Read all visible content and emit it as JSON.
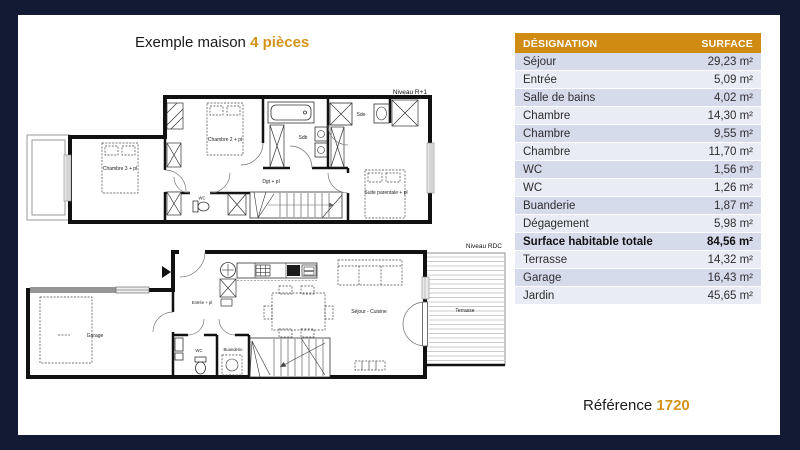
{
  "page": {
    "title_prefix": "Exemple maison",
    "title_highlight": "4 pièces",
    "reference_label": "Référence",
    "reference_value": "1720"
  },
  "table": {
    "header": {
      "designation": "DÉSIGNATION",
      "surface": "SURFACE"
    },
    "rows": [
      {
        "label": "Séjour",
        "value": "29,23 m²"
      },
      {
        "label": "Entrée",
        "value": "5,09 m²"
      },
      {
        "label": "Salle de bains",
        "value": "4,02 m²"
      },
      {
        "label": "Chambre",
        "value": "14,30 m²"
      },
      {
        "label": "Chambre",
        "value": "9,55 m²"
      },
      {
        "label": "Chambre",
        "value": "11,70 m²"
      },
      {
        "label": "WC",
        "value": "1,56 m²"
      },
      {
        "label": "WC",
        "value": "1,26 m²"
      },
      {
        "label": "Buanderie",
        "value": "1,87 m²"
      },
      {
        "label": "Dégagement",
        "value": "5,98 m²"
      },
      {
        "label": "Surface habitable totale",
        "value": "84,56 m²",
        "bold": true
      },
      {
        "label": "Terrasse",
        "value": "14,32 m²"
      },
      {
        "label": "Garage",
        "value": "16,43 m²"
      },
      {
        "label": "Jardin",
        "value": "45,65 m²"
      }
    ]
  },
  "plans": {
    "upper": {
      "level": "Niveau R+1",
      "labels": {
        "chambre2": "Chambre 2 + pl",
        "chambre3": "Chambre 3 + pl",
        "sdb": "Sdb",
        "sde": "Sde",
        "dgt": "Dgt + pl",
        "suite": "Suite parentale + pl",
        "wc": "WC"
      }
    },
    "ground": {
      "level": "Niveau RDC",
      "labels": {
        "entree": "Entrée + pl",
        "wc": "WC",
        "buanderie": "Buanderie",
        "sejour": "Séjour - Cuisine",
        "terrasse": "Terrasse",
        "garage": "Garage"
      }
    }
  },
  "colors": {
    "navy": "#131B34",
    "accent": "#D4941C",
    "table_header_bg": "#CF8B12",
    "row_shade_dark": "#D6DBEC",
    "row_shade_light": "#E9EBF5"
  }
}
